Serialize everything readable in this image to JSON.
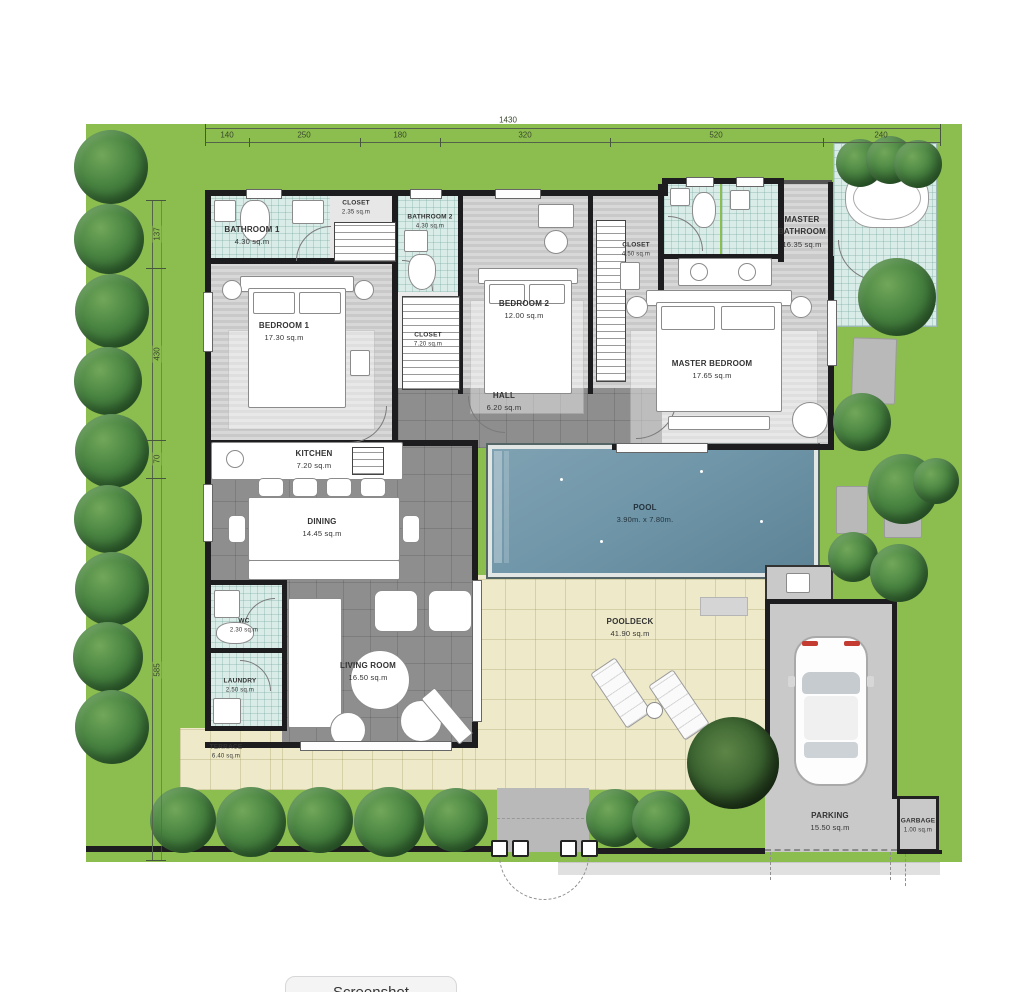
{
  "site": {
    "dimensions": {
      "top_total": "1430",
      "top_segments": [
        "140",
        "250",
        "180",
        "320",
        "520",
        "240"
      ],
      "left_segments": [
        "137",
        "430",
        "70",
        "585"
      ]
    }
  },
  "rooms": {
    "bathroom1": {
      "name": "BATHROOM 1",
      "area": "4.30 sq.m"
    },
    "closet1": {
      "name": "CLOSET",
      "area": "2.35 sq.m"
    },
    "bathroom2": {
      "name": "BATHROOM 2",
      "area": "4.30 sq.m"
    },
    "bedroom1": {
      "name": "BEDROOM 1",
      "area": "17.30 sq.m"
    },
    "closet2": {
      "name": "CLOSET",
      "area": "7.20 sq.m"
    },
    "bedroom2": {
      "name": "BEDROOM 2",
      "area": "12.00 sq.m"
    },
    "closet3": {
      "name": "CLOSET",
      "area": "4.50 sq.m"
    },
    "master_bathroom": {
      "name": "MASTER BATHROOM",
      "area": "16.35 sq.m"
    },
    "master_bedroom": {
      "name": "MASTER BEDROOM",
      "area": "17.65 sq.m"
    },
    "hall": {
      "name": "HALL",
      "area": "6.20 sq.m"
    },
    "kitchen": {
      "name": "KITCHEN",
      "area": "7.20 sq.m"
    },
    "dining": {
      "name": "DINING",
      "area": "14.45 sq.m"
    },
    "living_room": {
      "name": "LIVING ROOM",
      "area": "16.50 sq.m"
    },
    "wc": {
      "name": "WC",
      "area": "2.30 sq.m"
    },
    "laundry": {
      "name": "LAUNDRY",
      "area": "2.50 sq.m"
    },
    "terrace": {
      "name": "TERRACE",
      "area": "6.40 sq.m"
    },
    "pool": {
      "name": "POOL",
      "area": "3.90m. x 7.80m."
    },
    "pooldeck": {
      "name": "POOLDECK",
      "area": "41.90 sq.m"
    },
    "parking": {
      "name": "PARKING",
      "area": "15.50 sq.m"
    },
    "garbage": {
      "name": "GARBAGE",
      "area": "1.00 sq.m"
    }
  },
  "colors": {
    "lawn": "#8cbd4f",
    "pool_water": "#7096a9",
    "deck": "#eeeac9",
    "dark_tile": "#8e8e8e",
    "bath_tile": "#d9ece8",
    "wall": "#1d1d1f"
  },
  "ui": {
    "screenshot_label": "Screenshot"
  }
}
